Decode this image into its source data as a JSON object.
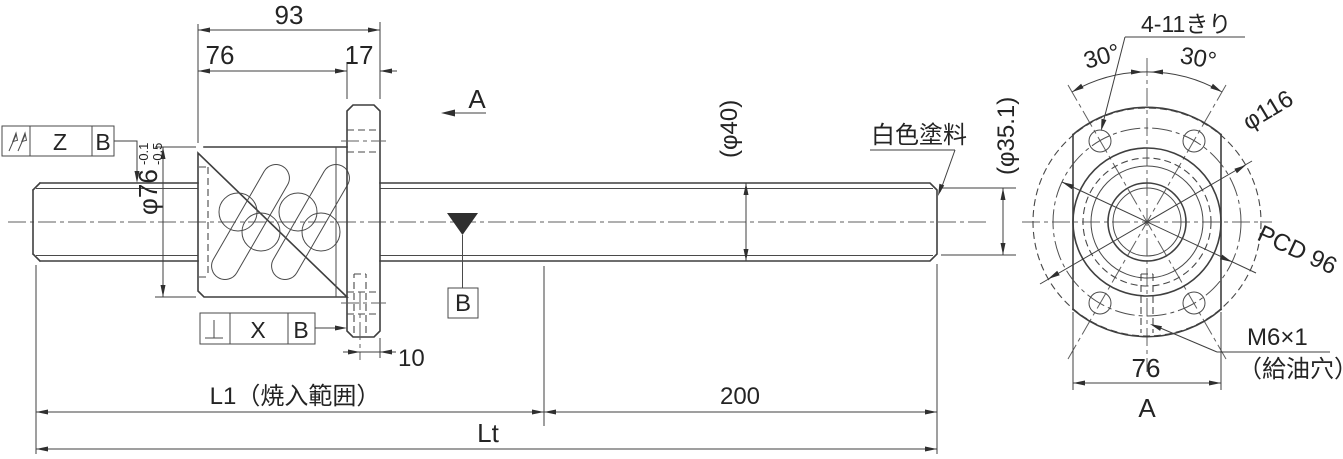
{
  "main_view": {
    "dimensions": {
      "overall_nut": "93",
      "nut_body_length": "76",
      "flange_thickness": "17",
      "nut_od": "φ76",
      "nut_od_tol_upper": "-0.1",
      "nut_od_tol_lower": "-0.5",
      "shaft_od": "(φ40)",
      "thread_root_od": "(φ35.1)",
      "oil_hole_offset": "10",
      "hardened_length": "L1（焼入範囲）",
      "unhardened_end_length": "200",
      "total_length": "Lt"
    },
    "labels": {
      "view_direction": "A",
      "surface_note": "白色塗料",
      "datum_label": "B"
    },
    "gdt_runout": {
      "symbol": "total-runout",
      "value": "Z",
      "datum": "B"
    },
    "gdt_perpendicularity": {
      "symbol": "perpendicularity",
      "value": "X",
      "datum": "B"
    }
  },
  "end_view": {
    "labels": {
      "bolt_holes": "4-11きり",
      "angle_left": "30°",
      "angle_right": "30°",
      "flange_od": "φ116",
      "bolt_circle": "PCD 96",
      "oil_hole": "M6×1",
      "oil_hole_note": "（給油穴）",
      "width_across_flats": "76",
      "view_label": "A"
    }
  }
}
